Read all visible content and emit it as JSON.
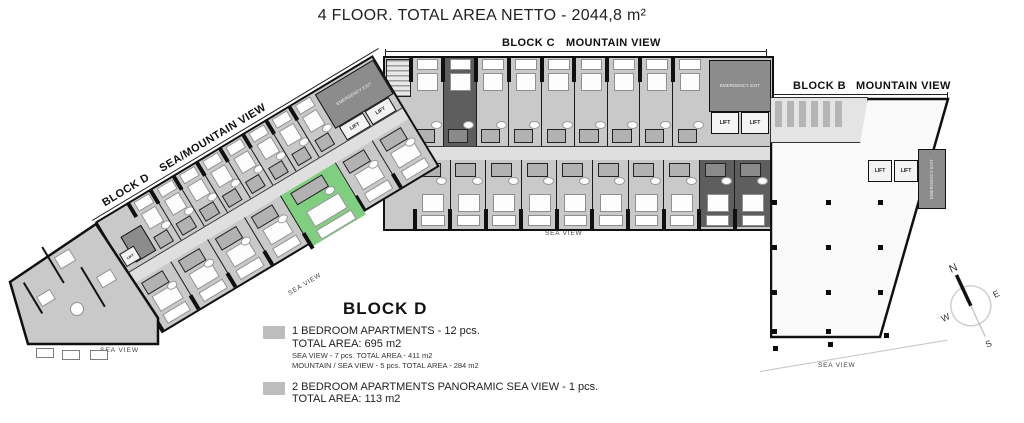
{
  "title": "4 FLOOR. TOTAL AREA NETTO - 2044,8 m²",
  "blocks": {
    "c": {
      "name": "BLOCK C",
      "view": "MOUNTAIN VIEW",
      "sea": "SEA VIEW"
    },
    "b": {
      "name": "BLOCK B",
      "view": "MOUNTAIN VIEW",
      "sea": "SEA VIEW",
      "admin": "ADMINISTRATION"
    },
    "d": {
      "name": "BLOCK D",
      "view": "SEA/MOUNTAIN VIEW",
      "sea_diagonal": "SEA VIEW",
      "sea_west": "SEA VIEW"
    }
  },
  "labels": {
    "lift": "LIFT",
    "emergency": "EMERGENCY EXIT"
  },
  "legend": {
    "title": "BLOCK D",
    "items": [
      {
        "line1": "1 BEDROOM APARTMENTS - 12 pcs.",
        "line2": "TOTAL AREA: 695 m2",
        "sub1": "SEA VIEW - 7 pcs. TOTAL AREA - 411 m2",
        "sub2": "MOUNTAIN / SEA VIEW - 5 pcs. TOTAL AREA - 284 m2"
      },
      {
        "line1": "2 BEDROOM APARTMENTS PANORAMIC SEA VIEW - 1 pcs.",
        "line2": "TOTAL AREA: 113 m2",
        "sub1": "",
        "sub2": ""
      }
    ]
  },
  "compass": {
    "n": "N",
    "e": "E",
    "s": "S",
    "w": "W"
  },
  "colors": {
    "unit": "#c9c9c9",
    "unit_dark": "#5e5e5e",
    "green": "#80cf80",
    "corridor": "#dfdfdf",
    "swatch": "#bdbdbd"
  },
  "plan": {
    "block_c_top": {
      "count": 9,
      "dark": [
        1
      ]
    },
    "block_c_bottom": {
      "count": 10,
      "dark": [
        8,
        9
      ]
    },
    "block_d_top": {
      "count": 8
    },
    "block_d_bottom": {
      "count": 7,
      "green": [
        4
      ]
    },
    "block_b_columns": {
      "cols": [
        2,
        56,
        108
      ],
      "rows": [
        103,
        148,
        193,
        232
      ]
    }
  }
}
